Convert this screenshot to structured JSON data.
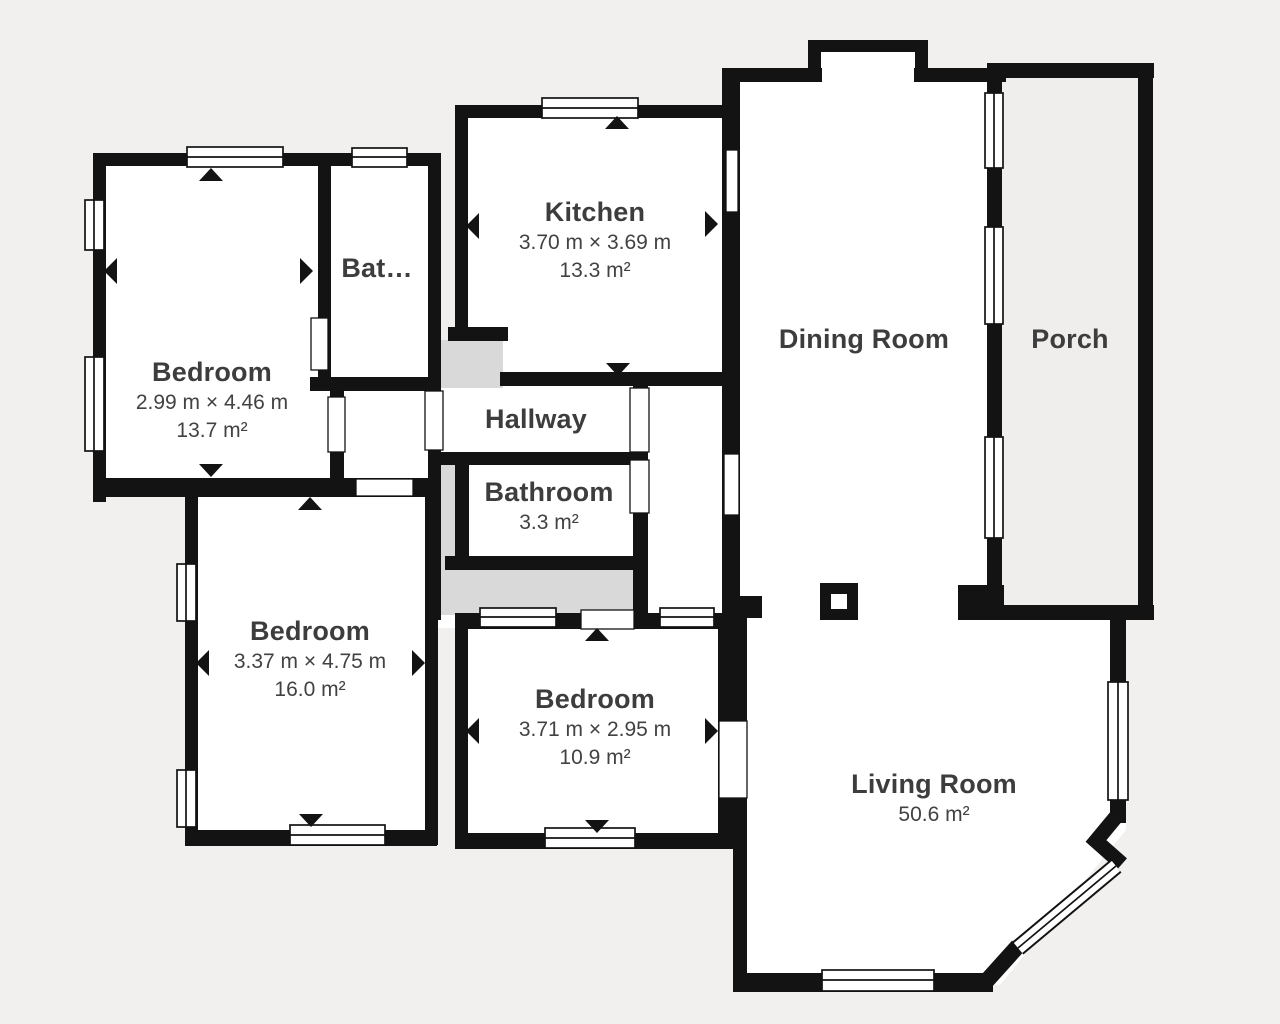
{
  "floorplan": {
    "title": "Apartment floor plan",
    "rooms": [
      {
        "id": "bedroom-top-left",
        "name": "Bedroom",
        "dims": "2.99 m × 4.46 m",
        "area": "13.7 m²"
      },
      {
        "id": "bathroom-truncated",
        "name": "Bat…"
      },
      {
        "id": "kitchen",
        "name": "Kitchen",
        "dims": "3.70 m × 3.69 m",
        "area": "13.3 m²"
      },
      {
        "id": "dining-room",
        "name": "Dining Room"
      },
      {
        "id": "porch",
        "name": "Porch"
      },
      {
        "id": "hallway",
        "name": "Hallway"
      },
      {
        "id": "bathroom",
        "name": "Bathroom",
        "area": "3.3 m²"
      },
      {
        "id": "bedroom-bottom-left",
        "name": "Bedroom",
        "dims": "3.37 m × 4.75 m",
        "area": "16.0 m²"
      },
      {
        "id": "bedroom-bottom-mid",
        "name": "Bedroom",
        "dims": "3.71 m × 2.95 m",
        "area": "10.9 m²"
      },
      {
        "id": "living-room",
        "name": "Living Room",
        "area": "50.6 m²"
      }
    ],
    "colors": {
      "wall-color": "#131313",
      "room-fill": "#ffffff",
      "porch-fill": "#f0eeec",
      "utility-fill": "#d9d9d9",
      "bg-color": "#f2f0ee",
      "text-color": "#3d3d3d"
    }
  }
}
